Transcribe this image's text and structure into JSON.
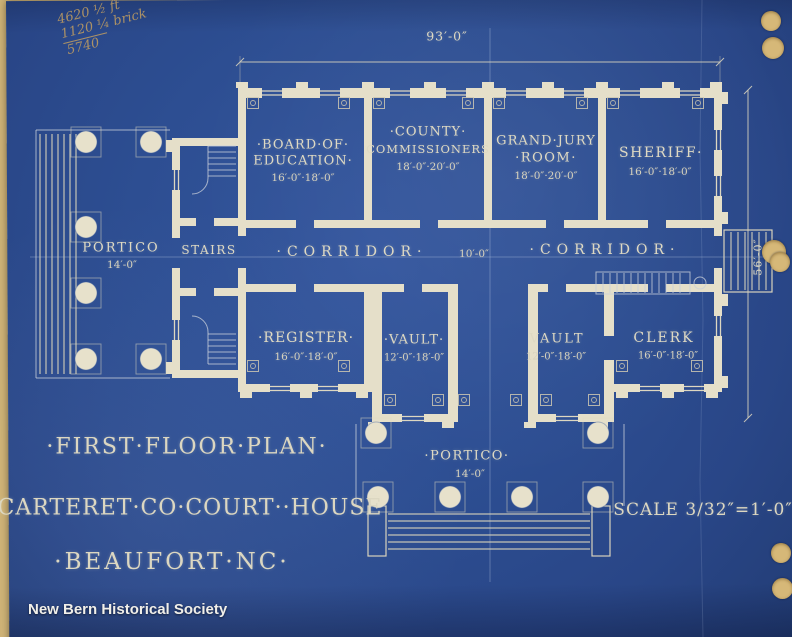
{
  "colors": {
    "blueprint_blue": "#2d4e92",
    "blueprint_blue_edge": "#223c74",
    "line_cream": "#e5dfc9",
    "paper_tan": "#d6b878",
    "watermark_white": "#f1efe9",
    "pencil_note": "#bb9a62"
  },
  "annotations": {
    "dimension_top": "93′-0″",
    "dimension_right": "56′-0″",
    "handwritten_note": {
      "line1": "4620 ½ ft",
      "line2": "1120 ¼ brick",
      "line3": "5740"
    },
    "watermark": "New Bern Historical Society"
  },
  "rooms": {
    "board_of_education": {
      "name_line1": "·BOARD·OF·",
      "name_line2": "EDUCATION·",
      "dims": "16′-0″·18′-0″"
    },
    "county_commissioners": {
      "name_line1": "·COUNTY·",
      "name_line2": "COMMISSIONERS",
      "dims": "18′-0″·20′-0″"
    },
    "grand_jury_room": {
      "name_line1": "GRAND·JURY",
      "name_line2": "·ROOM·",
      "dims": "18′-0″·20′-0″"
    },
    "sheriff": {
      "name_line1": "SHERIFF·",
      "dims": "16′-0″·18′-0″"
    },
    "register": {
      "name_line1": "·REGISTER·",
      "dims": "16′-0″·18′-0″"
    },
    "vault_left": {
      "name_line1": "·VAULT·",
      "dims": "12′-0″·18′-0″"
    },
    "vault_right": {
      "name_line1": "VAULT",
      "dims": "12′-0″·18′-0″"
    },
    "clerk": {
      "name_line1": "CLERK",
      "dims": "16′-0″·18′-0″"
    },
    "portico_left": {
      "name_line1": "PORTICO",
      "dims": "14′-0″"
    },
    "portico_bottom": {
      "name_line1": "·PORTICO·",
      "dims": "14′-0″"
    },
    "stairs": {
      "name_line1": "STAIRS"
    },
    "corridor_west": {
      "name_line1": "·CORRIDOR·"
    },
    "corridor_east": {
      "name_line1": "·CORRIDOR·"
    },
    "vestibule": {
      "dims": "10′-0″"
    }
  },
  "title_block": {
    "line1": "·FIRST·FLOOR·PLAN·",
    "line2": "CARTERET·CO·COURT··HOUSE",
    "line3": "·BEAUFORT·NC·",
    "scale": "SCALE 3/32″=1′-0″"
  }
}
